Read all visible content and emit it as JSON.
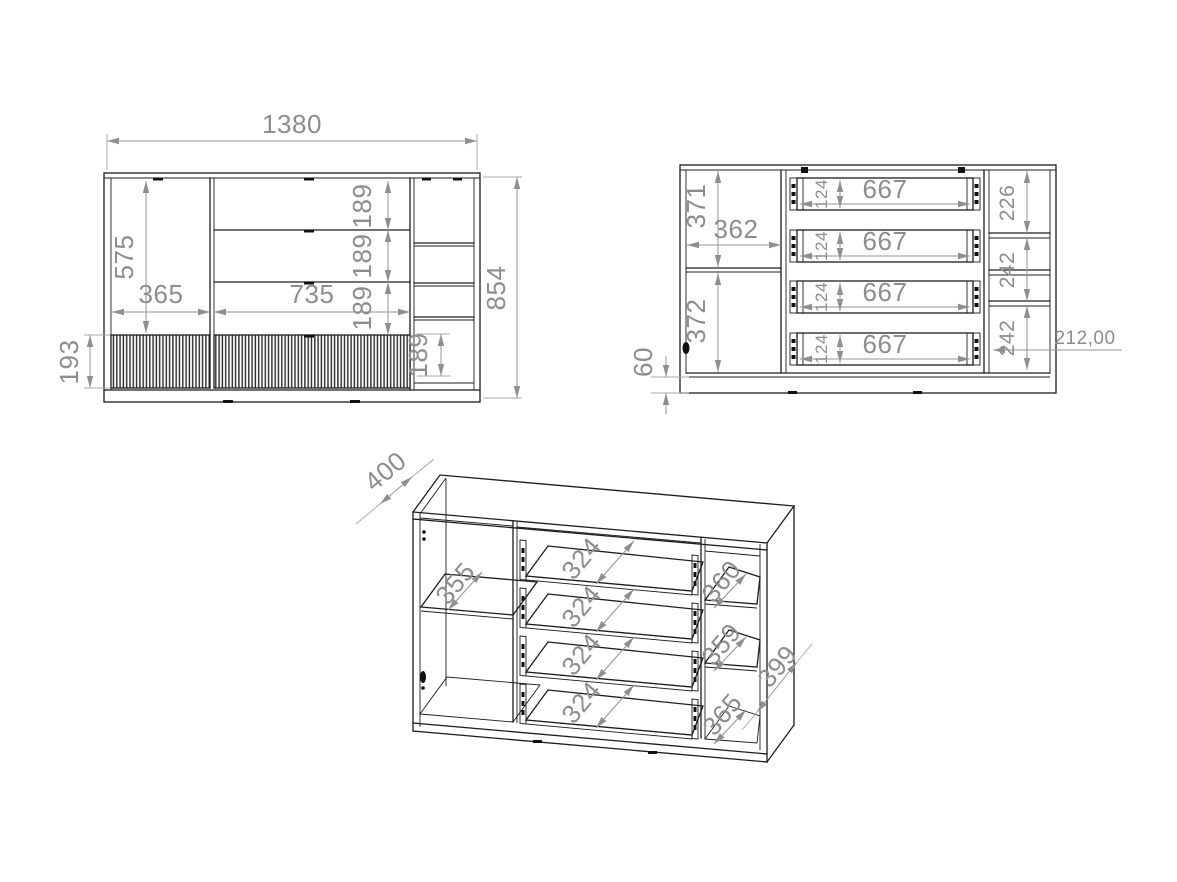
{
  "palette": {
    "ink": "#1d1d1d",
    "dimension": "#8d8d8d"
  },
  "drawing": {
    "front_view": {
      "overall_width": "1380",
      "overall_height": "854",
      "door_height": "575",
      "door_width": "365",
      "drawer_section_width": "735",
      "drawer_height_1": "189",
      "drawer_height_2": "189",
      "drawer_height_3": "189",
      "right_niche_height": "189",
      "base_front_height": "193"
    },
    "interior_view": {
      "upper_left_compartment": "371",
      "left_compartment_width": "362",
      "lower_left_compartment": "372",
      "plinth_height": "60",
      "drawer_inner_width_1": "667",
      "drawer_inner_width_2": "667",
      "drawer_inner_width_3": "667",
      "drawer_inner_width_4": "667",
      "drawer_inner_height_1": "124",
      "drawer_inner_height_2": "124",
      "drawer_inner_height_3": "124",
      "drawer_inner_height_4": "124",
      "right_compartment_1": "226",
      "right_compartment_2": "242",
      "right_compartment_3": "242",
      "depth_callout": "212,00"
    },
    "perspective_view": {
      "depth": "400",
      "left_shelf_depth": "355",
      "drawer_depth_1": "324",
      "drawer_depth_2": "324",
      "drawer_depth_3": "324",
      "drawer_depth_4": "324",
      "right_shelf_depth_1": "360",
      "right_shelf_depth_2": "359",
      "right_shelf_depth_3": "365",
      "side_panel_depth": "399"
    }
  }
}
